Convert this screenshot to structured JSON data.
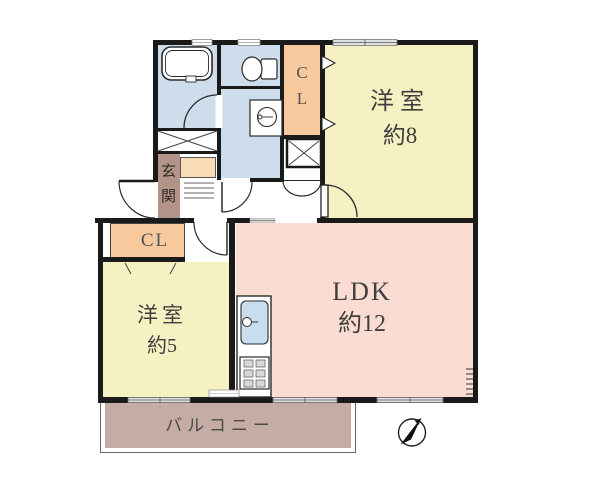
{
  "rooms": {
    "bedroom_large": {
      "line1": "洋室",
      "line2": "約8"
    },
    "ldk": {
      "line1": "LDK",
      "line2": "約12"
    },
    "bedroom_small": {
      "line1": "洋室",
      "line2": "約5"
    },
    "closet_upper": {
      "char1": "C",
      "char2": "L"
    },
    "closet_lower": {
      "label": "CL"
    },
    "entrance": {
      "char1": "玄",
      "char2": "関"
    },
    "balcony": {
      "label": "バルコニー"
    }
  },
  "colors": {
    "room_yellow": "#f6f1c3",
    "room_pink": "#fbdcd2",
    "water_blue": "#cdddeb",
    "closet_orange": "#f7c99d",
    "shoe_peach": "#f9dcb6",
    "entrance_brown": "#b29588",
    "balcony_mauve": "#c5aca4",
    "wall": "#1a1a1a",
    "sink_blue": "#c8deee"
  }
}
